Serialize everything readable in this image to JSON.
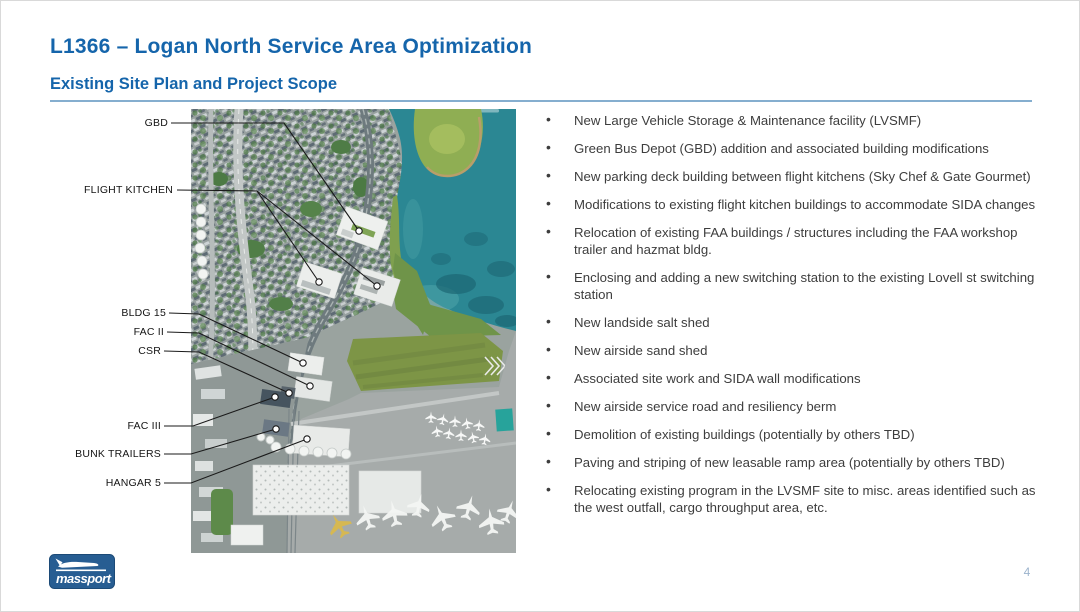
{
  "slide": {
    "title": "L1366 – Logan North Service Area Optimization",
    "subtitle": "Existing Site Plan and Project Scope",
    "page_number": "4"
  },
  "branding": {
    "logo_text": "massport"
  },
  "map": {
    "labels": [
      "GBD",
      "FLIGHT KITCHEN",
      "BLDG 15",
      "FAC II",
      "CSR",
      "FAC III",
      "BUNK TRAILERS",
      "HANGAR 5"
    ]
  },
  "scope": {
    "items": [
      "New Large Vehicle Storage & Maintenance facility (LVSMF)",
      "Green Bus Depot (GBD) addition and associated building modifications",
      "New parking deck building between flight kitchens (Sky Chef & Gate Gourmet)",
      "Modifications to existing flight kitchen buildings to accommodate SIDA changes",
      "Relocation of existing FAA buildings / structures including the FAA workshop trailer and hazmat bldg.",
      "Enclosing and adding a new switching station to the existing Lovell st switching station",
      "New landside salt shed",
      "New airside sand shed",
      "Associated site work and SIDA wall modifications",
      "New airside service road and resiliency berm",
      "Demolition of existing buildings (potentially by others TBD)",
      "Paving and striping of new leasable ramp area (potentially by others TBD)",
      "Relocating existing program in the LVSMF site to misc. areas identified such as the west outfall, cargo throughput area, etc."
    ]
  },
  "colors": {
    "accent_blue": "#1565ab",
    "divider_blue": "#85aecf",
    "body_text": "#3d3d3d",
    "logo_blue": "#275d92",
    "water_teal": "#2b8793",
    "grass_green": "#7d9546"
  }
}
